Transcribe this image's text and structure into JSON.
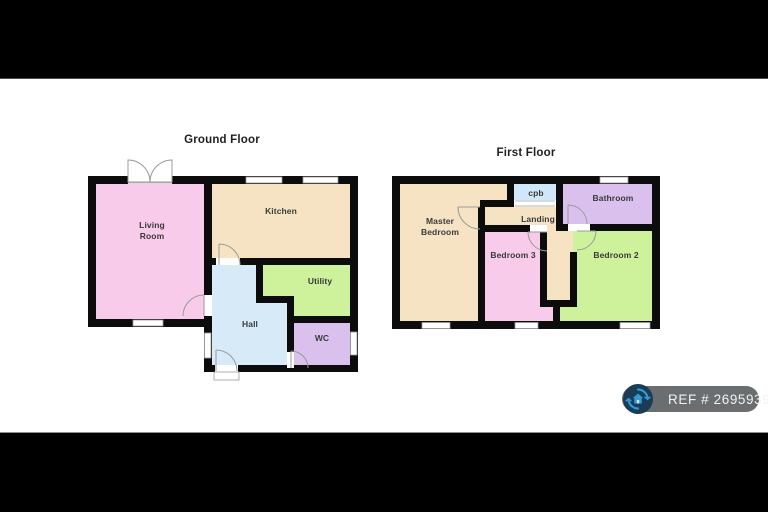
{
  "titles": {
    "ground_floor": "Ground Floor",
    "first_floor": "First Floor"
  },
  "rooms": {
    "living_line1": "Living",
    "living_line2": "Room",
    "kitchen": "Kitchen",
    "utility": "Utility",
    "hall": "Hall",
    "wc": "WC",
    "master_line1": "Master",
    "master_line2": "Bedroom",
    "cpb": "cpb",
    "landing": "Landing",
    "bathroom": "Bathroom",
    "bedroom3": "Bedroom 3",
    "bedroom2": "Bedroom 2"
  },
  "colors": {
    "room_pink": "#f7cbe9",
    "room_cream": "#f5e3c3",
    "room_green": "#cdf29b",
    "room_blue": "#d7eaf8",
    "room_purple": "#d9c0ed",
    "room_light_blue": "#cfe7f8",
    "badge_bg": "#6a6e70",
    "badge_icon_bg": "#1b3c55",
    "badge_icon_accent": "#2e9bd6",
    "badge_icon_house": "#cde4f5"
  },
  "badge": {
    "ref_text": "REF # 2695939"
  }
}
